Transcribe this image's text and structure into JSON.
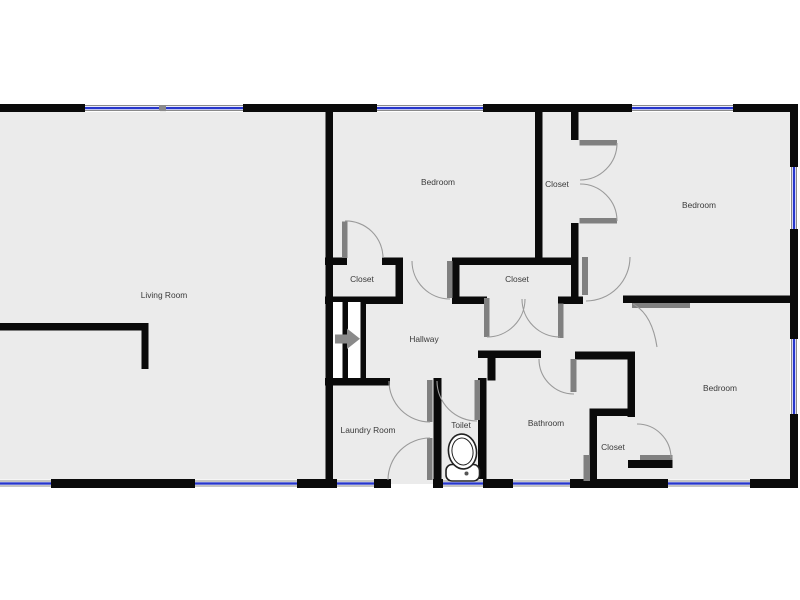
{
  "floorplan": {
    "type": "residential-floor-plan",
    "rooms": {
      "living_room": {
        "label": "Living Room"
      },
      "bedroom_top_middle": {
        "label": "Bedroom"
      },
      "bedroom_top_right": {
        "label": "Bedroom"
      },
      "bedroom_bottom_right": {
        "label": "Bedroom"
      },
      "closet_bedroom1": {
        "label": "Closet"
      },
      "closet_tall": {
        "label": "Closet"
      },
      "closet_central": {
        "label": "Closet"
      },
      "closet_bedroom3": {
        "label": "Closet"
      },
      "hallway": {
        "label": "Hallway"
      },
      "laundry_room": {
        "label": "Laundry Room"
      },
      "toilet": {
        "label": "Toilet"
      },
      "bathroom": {
        "label": "Bathroom"
      }
    },
    "colors": {
      "wall": "#0a0a0a",
      "floor": "#ebebeb",
      "window_glass": "#2636cc",
      "window_frame": "#8a8a8a",
      "door_swing": "#9a9a9a",
      "door_panel": "#808080",
      "label_text": "#3a3a3a",
      "background": "#ffffff"
    }
  }
}
